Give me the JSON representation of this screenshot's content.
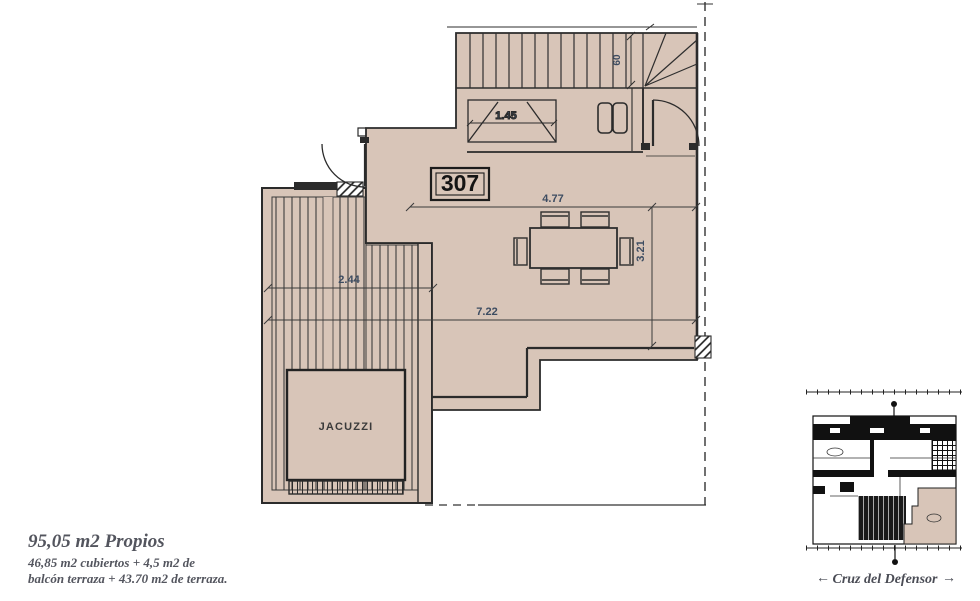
{
  "drawing": {
    "unit_number": "307",
    "room_labels": {
      "jacuzzi": "JACUZZI"
    },
    "dimensions": {
      "living_width": "4.77",
      "living_depth": "3.21",
      "terrace_length": "7.22",
      "deck_width": "2.44",
      "hall_width": "1.45",
      "stair_width": "60"
    }
  },
  "notes": {
    "title": "95,05 m2 Propios",
    "line1": "46,85 m2 cubiertos + 4,5 m2 de",
    "line2": "balcón terraza + 43.70 m2 de terraza."
  },
  "key_plan": {
    "street_label": "Cruz del Defensor",
    "arrow_left": "←",
    "arrow_right": "→"
  },
  "colors": {
    "floor_fill": "#d8c5b8",
    "wall_line": "#2b2b2b",
    "dimension_text": "#3d4c61",
    "note_text": "#53555e"
  }
}
